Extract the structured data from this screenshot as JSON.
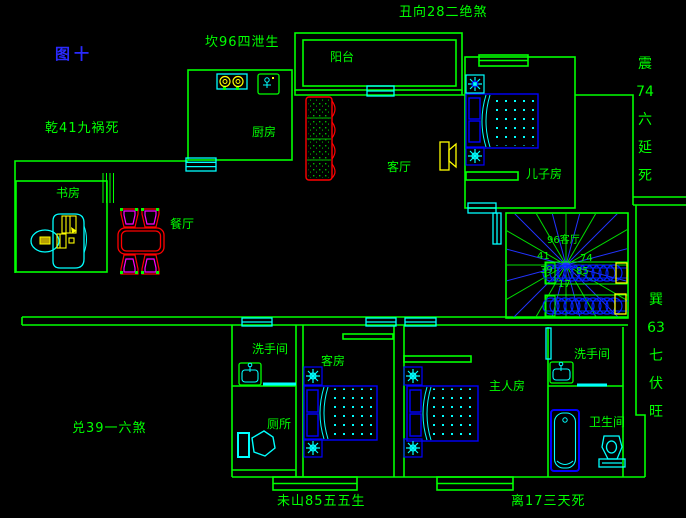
{
  "figure": {
    "title": "图十"
  },
  "colors": {
    "background": "#000000",
    "wall_green": "#00ff00",
    "opening_cyan": "#00ffff",
    "furniture_blue": "#0000ff",
    "highlight_yellow": "#ffff00",
    "sofa_red": "#ff0000",
    "chair_magenta": "#ff00ff",
    "title_blue": "#2a2aff"
  },
  "fengshui_annotations": {
    "north_top": "坎96四泄生",
    "northeast_top_right": "丑向28二绝煞",
    "northwest_left": "乾41九祸死",
    "east_right_upper": "震\n74\n六\n延\n死",
    "southeast_right_lower": "巽\n63\n七\n伏\n旺",
    "west_bottom_left": "兑39一六煞",
    "south_bottom_center": "未山85五五生",
    "south_bottom_right": "离17三天死"
  },
  "room_labels": {
    "balcony": "阳台",
    "kitchen": "厨房",
    "living_room": "客厅",
    "sons_room": "儿子房",
    "study": "书房",
    "dining_room": "餐厅",
    "washroom_lower_left": "洗手间",
    "toilet": "厕所",
    "guest_room": "客房",
    "master_room": "主人房",
    "washroom_right": "洗手间",
    "bathroom": "卫生间"
  },
  "staircase_compass": {
    "center_label": "96客厅",
    "numbers": [
      "41",
      "74",
      "39",
      "85",
      "17"
    ]
  }
}
